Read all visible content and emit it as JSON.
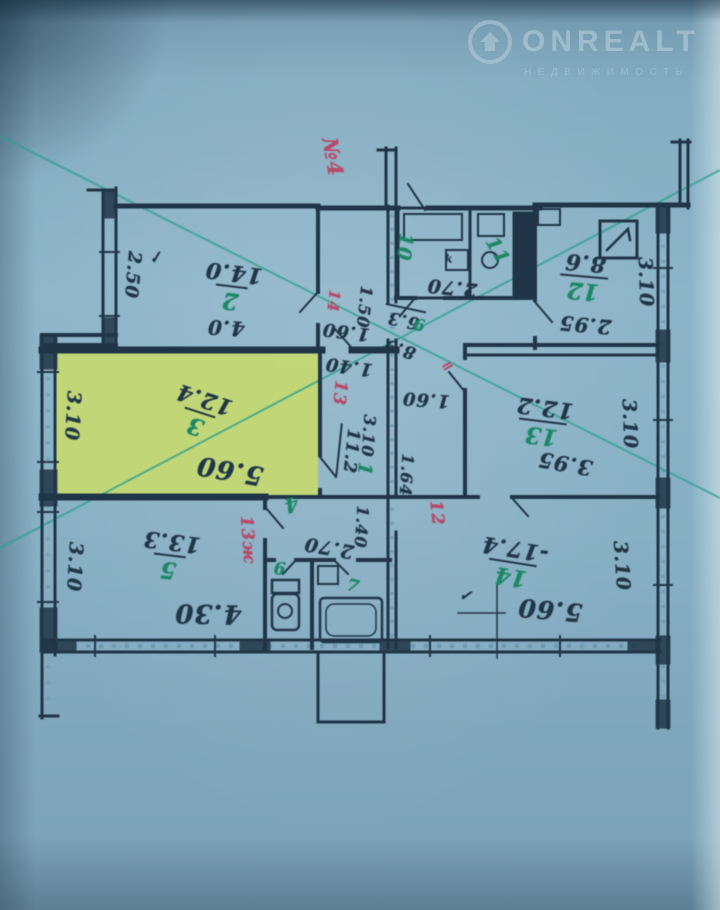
{
  "watermark": {
    "brand": "ONREALT",
    "tagline": "НЕДВИЖИМОСТЬ",
    "logo": "house-icon"
  },
  "palette": {
    "background": "#87aec2",
    "ink": "#17293a",
    "highlight": "#cfe066",
    "green": "#12845c",
    "red": "#bf3f60",
    "teal": "#2aa18c",
    "chalk": "#4f86a8",
    "wm": "rgba(223,238,243,0.40)"
  },
  "plan": {
    "apartment_annotation": "№4",
    "highlighted_room_number": "3",
    "rooms": [
      {
        "number": "1",
        "area": "11.2",
        "highlighted": false
      },
      {
        "number": "2",
        "area": "14.0",
        "dims": [
          "4.0",
          "2.50"
        ],
        "highlighted": false
      },
      {
        "number": "3",
        "area": "12.4",
        "dims": [
          "5.60",
          "3.10"
        ],
        "highlighted": true
      },
      {
        "number": "4",
        "dims": [
          "2.70",
          "1.40"
        ],
        "highlighted": false
      },
      {
        "number": "5",
        "area": "13.3",
        "dims": [
          "4.30",
          "3.10"
        ],
        "highlighted": false
      },
      {
        "number": "6",
        "highlighted": false
      },
      {
        "number": "7",
        "highlighted": false
      },
      {
        "number": "9",
        "area": "6.3",
        "highlighted": false
      },
      {
        "number": "10",
        "highlighted": false
      },
      {
        "number": "11",
        "highlighted": false
      },
      {
        "number": "12",
        "area": "8.6",
        "dims": [
          "2.95",
          "3.10"
        ],
        "highlighted": false
      },
      {
        "number": "13",
        "area": "12.2",
        "dims": [
          "3.95",
          "3.10"
        ],
        "highlighted": false
      },
      {
        "number": "14",
        "area": "17.4",
        "dims": [
          "5.60",
          "3.10"
        ],
        "highlighted": false
      }
    ],
    "red_annotations": [
      "№4",
      "14",
      "13",
      "13ж",
      "12"
    ],
    "room_labels": [
      {
        "id": "room-2",
        "num": "2",
        "area": "14.0",
        "x": 232,
        "y": 287,
        "r": 187
      },
      {
        "id": "room-3",
        "num": "3",
        "area": "12.4",
        "x": 200,
        "y": 413,
        "r": 198
      },
      {
        "id": "room-5",
        "num": "5",
        "area": "13.3",
        "x": 170,
        "y": 556,
        "r": 187
      },
      {
        "id": "room-12",
        "num": "12",
        "area": "8.6",
        "x": 584,
        "y": 277,
        "r": 185
      },
      {
        "id": "room-13",
        "num": "13",
        "area": "12.2",
        "x": 543,
        "y": 422,
        "r": 187
      },
      {
        "id": "room-14",
        "num": "14",
        "area": "-17.4",
        "x": 513,
        "y": 563,
        "r": 189
      }
    ],
    "labels": [
      {
        "id": "dim-2-50",
        "t": "2.50",
        "x": 132,
        "y": 275,
        "r": 95,
        "c": "ink",
        "s": 18
      },
      {
        "id": "dim-4-0",
        "t": "4.0",
        "x": 226,
        "y": 328,
        "r": 183,
        "c": "ink",
        "s": 20
      },
      {
        "id": "dim-5-60-r3",
        "t": "5.60",
        "x": 230,
        "y": 470,
        "r": 190,
        "c": "ink",
        "s": 26
      },
      {
        "id": "dim-3-10-r3",
        "t": "3.10",
        "x": 72,
        "y": 416,
        "r": 93,
        "c": "ink",
        "s": 19
      },
      {
        "id": "dim-4-30",
        "t": "4.30",
        "x": 208,
        "y": 613,
        "r": 181,
        "c": "ink",
        "s": 26
      },
      {
        "id": "dim-3-10-r5",
        "t": "3.10",
        "x": 74,
        "y": 567,
        "r": 93,
        "c": "ink",
        "s": 19
      },
      {
        "id": "dim-5-60-r14",
        "t": "5.60",
        "x": 550,
        "y": 610,
        "r": 185,
        "c": "ink",
        "s": 25
      },
      {
        "id": "dim-3-10-r14",
        "t": "3.10",
        "x": 621,
        "y": 566,
        "r": 86,
        "c": "ink",
        "s": 19
      },
      {
        "id": "dim-3-95",
        "t": "3.95",
        "x": 565,
        "y": 464,
        "r": 190,
        "c": "ink",
        "s": 21
      },
      {
        "id": "dim-3-10-r13",
        "t": "3.10",
        "x": 629,
        "y": 424,
        "r": 88,
        "c": "ink",
        "s": 19
      },
      {
        "id": "dim-2-95",
        "t": "2.95",
        "x": 585,
        "y": 325,
        "r": 185,
        "c": "ink",
        "s": 20
      },
      {
        "id": "dim-3-10-r12",
        "t": "3.10",
        "x": 645,
        "y": 282,
        "r": 88,
        "c": "ink",
        "s": 19
      },
      {
        "id": "dim-2-70-top",
        "t": "2.70",
        "x": 452,
        "y": 287,
        "r": 186,
        "c": "ink",
        "s": 19
      },
      {
        "id": "dim-1-50",
        "t": "1.50",
        "x": 364,
        "y": 307,
        "r": 96,
        "c": "ink",
        "s": 16
      },
      {
        "id": "dim-1-60-a",
        "t": "1.60",
        "x": 346,
        "y": 331,
        "r": 187,
        "c": "ink",
        "s": 18
      },
      {
        "id": "dim-1-40-a",
        "t": "1.40",
        "x": 349,
        "y": 366,
        "r": 188,
        "c": "ink",
        "s": 18
      },
      {
        "id": "dim-6-3",
        "t": "6.3",
        "x": 404,
        "y": 318,
        "r": 192,
        "c": "ink",
        "s": 17,
        "ul": 1
      },
      {
        "id": "dim-8-9",
        "t": "8.9",
        "x": 400,
        "y": 348,
        "r": 197,
        "c": "ink",
        "s": 17
      },
      {
        "id": "dim-1-60-b",
        "t": "1.60",
        "x": 426,
        "y": 399,
        "r": 184,
        "c": "ink",
        "s": 18
      },
      {
        "id": "dim-1-64",
        "t": "1.64",
        "x": 406,
        "y": 475,
        "r": 94,
        "c": "ink",
        "s": 16
      },
      {
        "id": "dim-3-10-corr",
        "t": "3.10",
        "x": 368,
        "y": 436,
        "r": 94,
        "c": "ink",
        "s": 16
      },
      {
        "id": "area-11-2",
        "t": "11.2",
        "x": 349,
        "y": 451,
        "r": 96,
        "c": "ink",
        "s": 17,
        "ul": 1
      },
      {
        "id": "dim-2-70-bot",
        "t": "2.70",
        "x": 329,
        "y": 547,
        "r": 190,
        "c": "ink",
        "s": 19
      },
      {
        "id": "dim-1-40-b",
        "t": "1.40",
        "x": 361,
        "y": 527,
        "r": 94,
        "c": "ink",
        "s": 16
      },
      {
        "id": "check-room2",
        "t": "✓",
        "x": 156,
        "y": 258,
        "r": -15,
        "c": "ink",
        "s": 15
      },
      {
        "id": "check-room14",
        "t": "✓",
        "x": 466,
        "y": 596,
        "r": 8,
        "c": "ink",
        "s": 15
      },
      {
        "id": "vent-k",
        "t": "k",
        "x": 449,
        "y": 259,
        "r": 0,
        "c": "ink",
        "s": 11
      },
      {
        "id": "num-1",
        "t": "1",
        "x": 364,
        "y": 469,
        "r": 96,
        "c": "green",
        "s": 19
      },
      {
        "id": "num-4",
        "t": "4",
        "x": 291,
        "y": 505,
        "r": 165,
        "c": "green",
        "s": 20
      },
      {
        "id": "num-6",
        "t": "6",
        "x": 280,
        "y": 570,
        "r": 5,
        "c": "green",
        "s": 17
      },
      {
        "id": "num-7",
        "t": "7",
        "x": 353,
        "y": 587,
        "r": 15,
        "c": "green",
        "s": 17
      },
      {
        "id": "num-9",
        "t": "9",
        "x": 419,
        "y": 324,
        "r": 190,
        "c": "green",
        "s": 16
      },
      {
        "id": "num-10",
        "t": "10",
        "x": 404,
        "y": 247,
        "r": 96,
        "c": "green",
        "s": 19
      },
      {
        "id": "num-11",
        "t": "11",
        "x": 497,
        "y": 251,
        "r": 60,
        "c": "green",
        "s": 19
      },
      {
        "id": "red-apt-4",
        "t": "№4",
        "x": 333,
        "y": 157,
        "r": 80,
        "c": "red",
        "s": 21
      },
      {
        "id": "red-14",
        "t": "14",
        "x": 333,
        "y": 301,
        "r": 96,
        "c": "red",
        "s": 15
      },
      {
        "id": "red-13",
        "t": "13",
        "x": 339,
        "y": 393,
        "r": 96,
        "c": "red",
        "s": 17
      },
      {
        "id": "red-13zh",
        "t": "13ж",
        "x": 247,
        "y": 540,
        "r": 86,
        "c": "red",
        "s": 17
      },
      {
        "id": "red-12",
        "t": "12",
        "x": 436,
        "y": 513,
        "r": 84,
        "c": "red",
        "s": 17
      },
      {
        "id": "red-mark",
        "t": "=",
        "x": 448,
        "y": 366,
        "r": -28,
        "c": "red",
        "s": 15
      }
    ]
  }
}
